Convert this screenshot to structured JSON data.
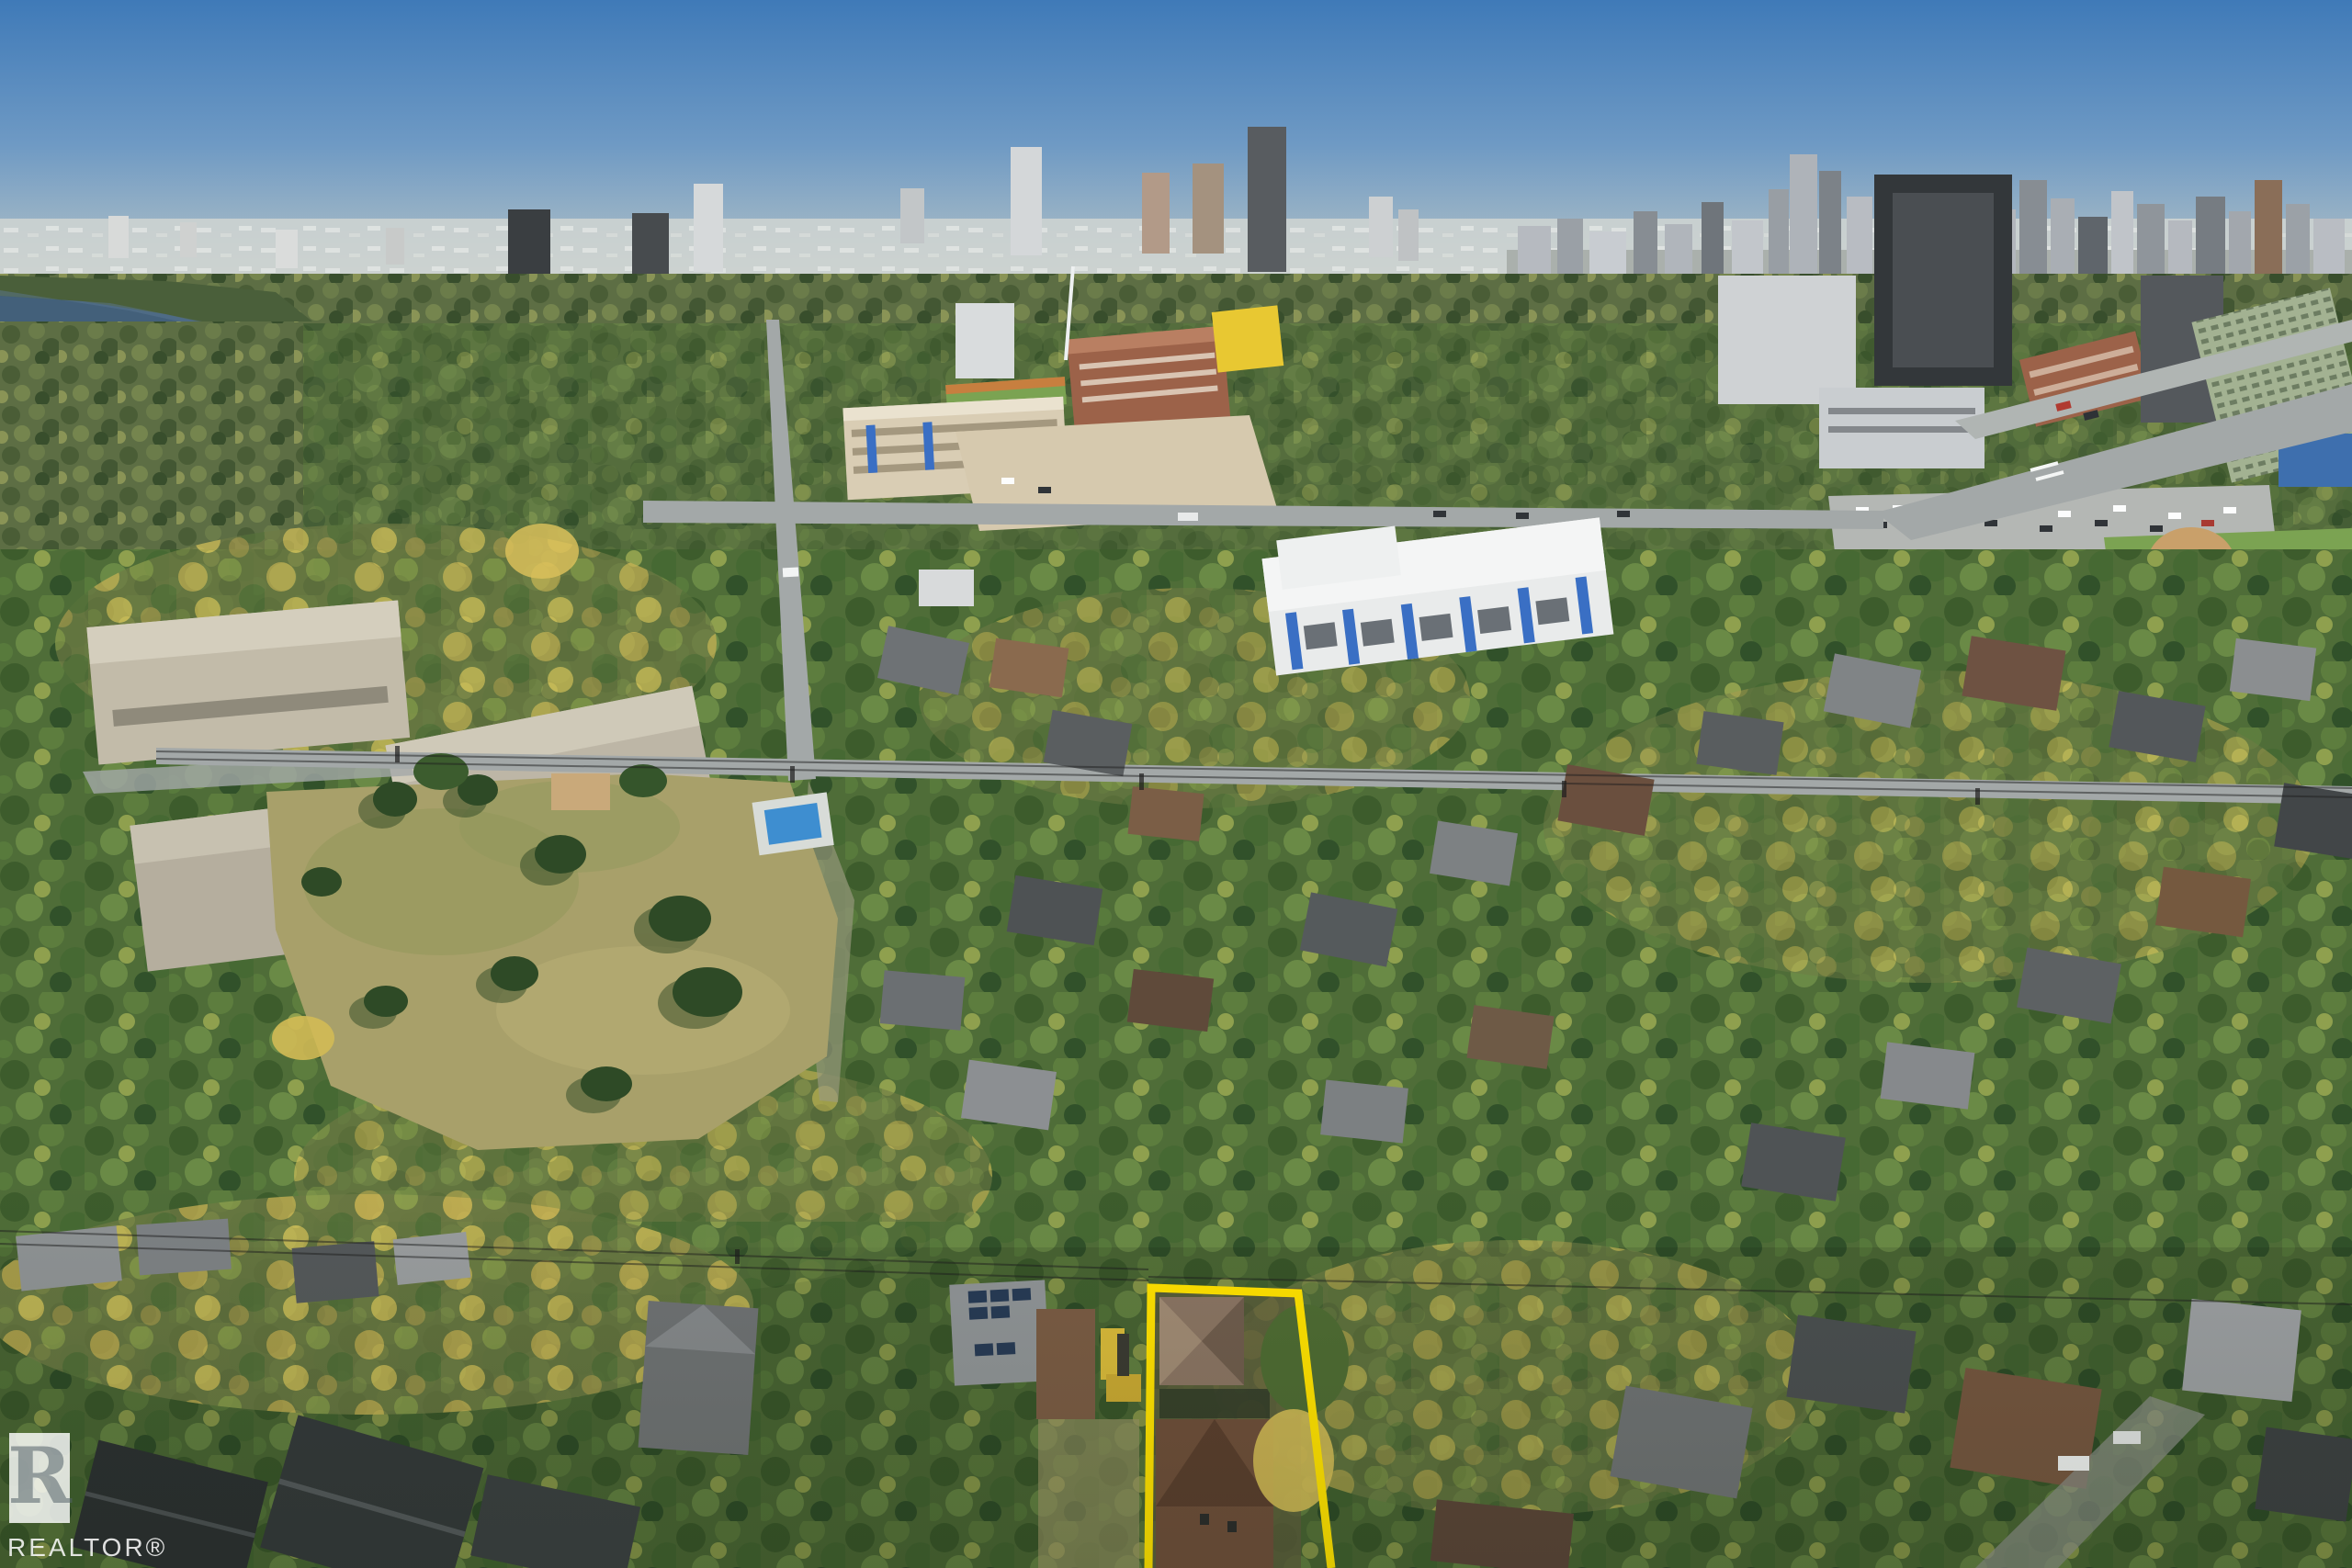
{
  "watermark": {
    "monogram": "R",
    "label": "REALTOR®"
  },
  "colors": {
    "sky_top": "#3f7ab8",
    "sky_horizon": "#cfd6d2",
    "haze_band": "#d0d5d1",
    "river": "#43607a",
    "bridge": "#cdd3d5",
    "evergreen": "#2e4a26",
    "autumn_foliage": "#d2ba55",
    "park_grass": "#a8a06a",
    "sports_field": "#7ba352",
    "road": "#a3a8a8",
    "campus_cream": "#d9cdb4",
    "brick": "#9c6249",
    "butterdome_yellow": "#e8c832",
    "condo_accent_blue": "#3a6fc4",
    "pool_blue": "#3e8ed0",
    "boundary_yellow": "#ffe100",
    "watermark_white": "#ffffff"
  }
}
